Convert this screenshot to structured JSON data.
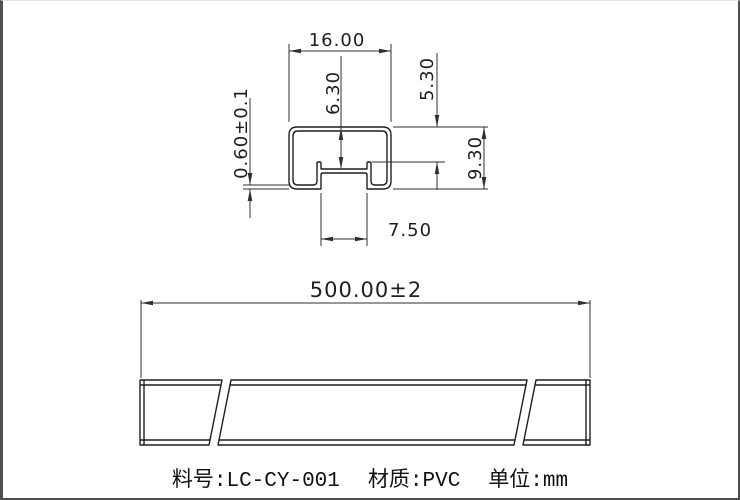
{
  "cross_section": {
    "width": "16.00",
    "inner_depth": "6.30",
    "lip_depth": "5.30",
    "height": "9.30",
    "slot_width": "7.50",
    "wall_thickness": "0.60±0.1"
  },
  "side_view": {
    "length": "500.00±2"
  },
  "footer": {
    "part_no": "料号:LC-CY-001",
    "material": "材质:PVC",
    "unit": "单位:mm"
  },
  "colors": {
    "line": "#2f2f2f",
    "outline": "#1f1f1f",
    "background": "#ffffff",
    "frame": "#4f4f4f"
  }
}
